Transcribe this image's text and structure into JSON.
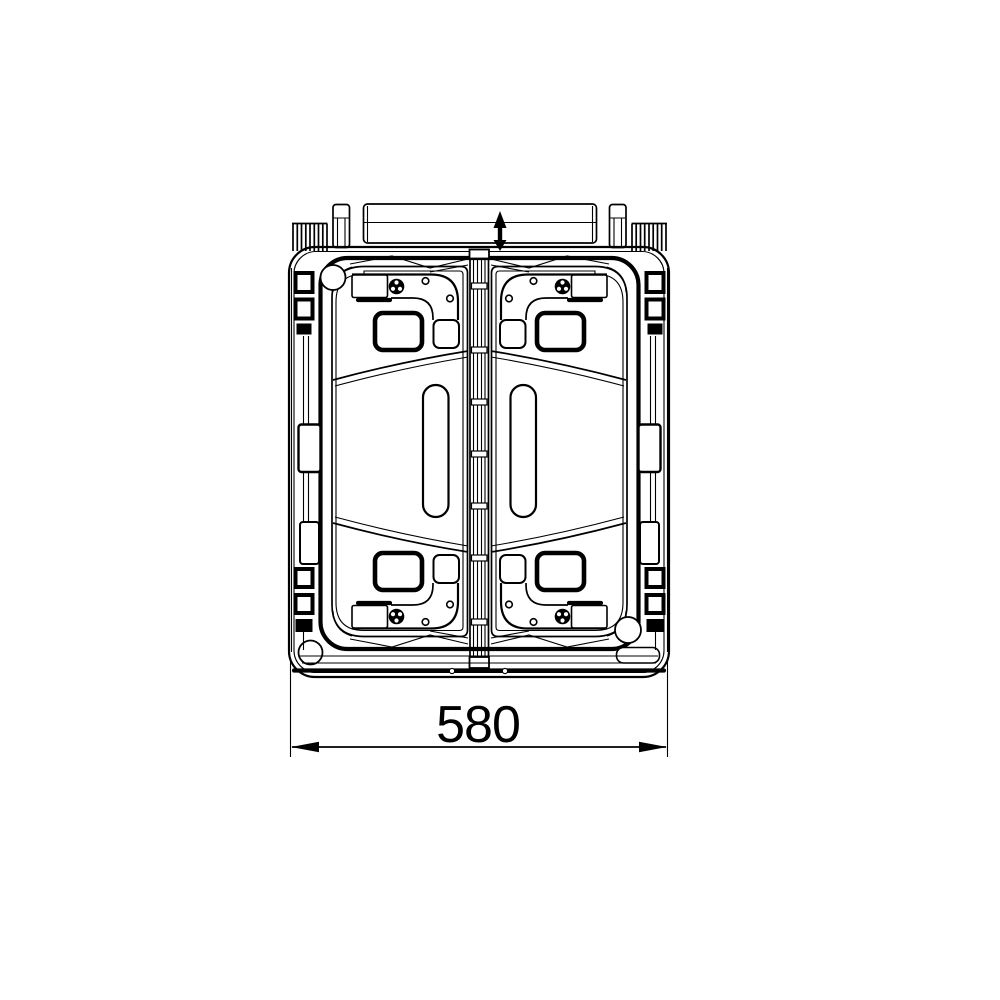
{
  "page": {
    "background": "#ffffff"
  },
  "drawing": {
    "type": "technical-drawing-top-view",
    "dimension_label": "580",
    "colors": {
      "line": "#000000",
      "background": "#ffffff"
    },
    "icons": {
      "direction_arrow_icon": "double-headed vertical arrow",
      "screw_head_icon": "circle with three dots",
      "corner_hole_icon": "circle",
      "dimension_arrow_left_icon": "solid left arrowhead",
      "dimension_arrow_right_icon": "solid right arrowhead"
    }
  }
}
